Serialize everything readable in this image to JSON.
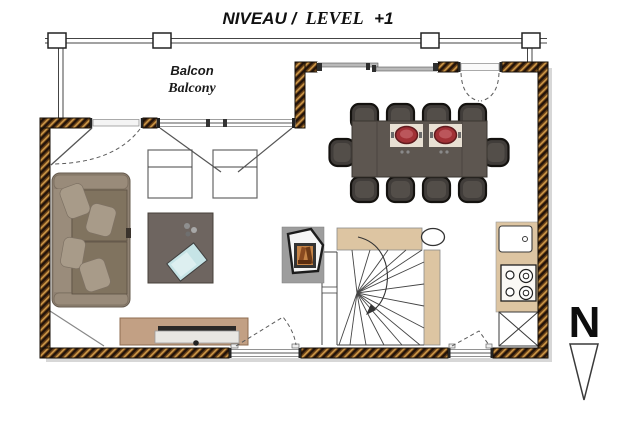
{
  "title": {
    "fr": "NIVEAU /",
    "en": "LEVEL",
    "suffix": "+1"
  },
  "balcony": {
    "label_fr": "Balcon",
    "label_en": "Balcony"
  },
  "compass": {
    "label": "N",
    "arrow": "points-down"
  },
  "colors": {
    "wall_dark": "#22130a",
    "wall_hatch_orange": "#cf9a4a",
    "wall_base_brown": "#6b4218",
    "partition_beige": "#ddc5a2",
    "dining_table": "#5d5650",
    "chair_upholstery": "#413d3a",
    "placemat": "#e8e0d3",
    "hot_pot_red": "#a13136",
    "sofa_body": "#8f8172",
    "sofa_pillow": "#a89b89",
    "coffee_table": "#6e6560",
    "tablet_blue": "#c6e4e6",
    "tv_cabinet_tan": "#c2a084",
    "stove_base_gray": "#9d9d9d",
    "fire_orange": "#c58346",
    "window_frame_gray": "#b9b9b9"
  },
  "furniture": {
    "dining_seats": 10,
    "hot_pots": 2,
    "items": [
      "sofa",
      "armchair",
      "armchair",
      "coffee-table",
      "tv-cabinet",
      "dining-table",
      "wood-stove",
      "winder-staircase",
      "column",
      "kitchen-sink",
      "cooktop-4-burners",
      "appliance-cabinet",
      "balcony-railing"
    ]
  },
  "openings": [
    "balcony-door",
    "french-window",
    "sliding-window",
    "entry-door",
    "bottom-window-left",
    "bottom-window-right"
  ]
}
